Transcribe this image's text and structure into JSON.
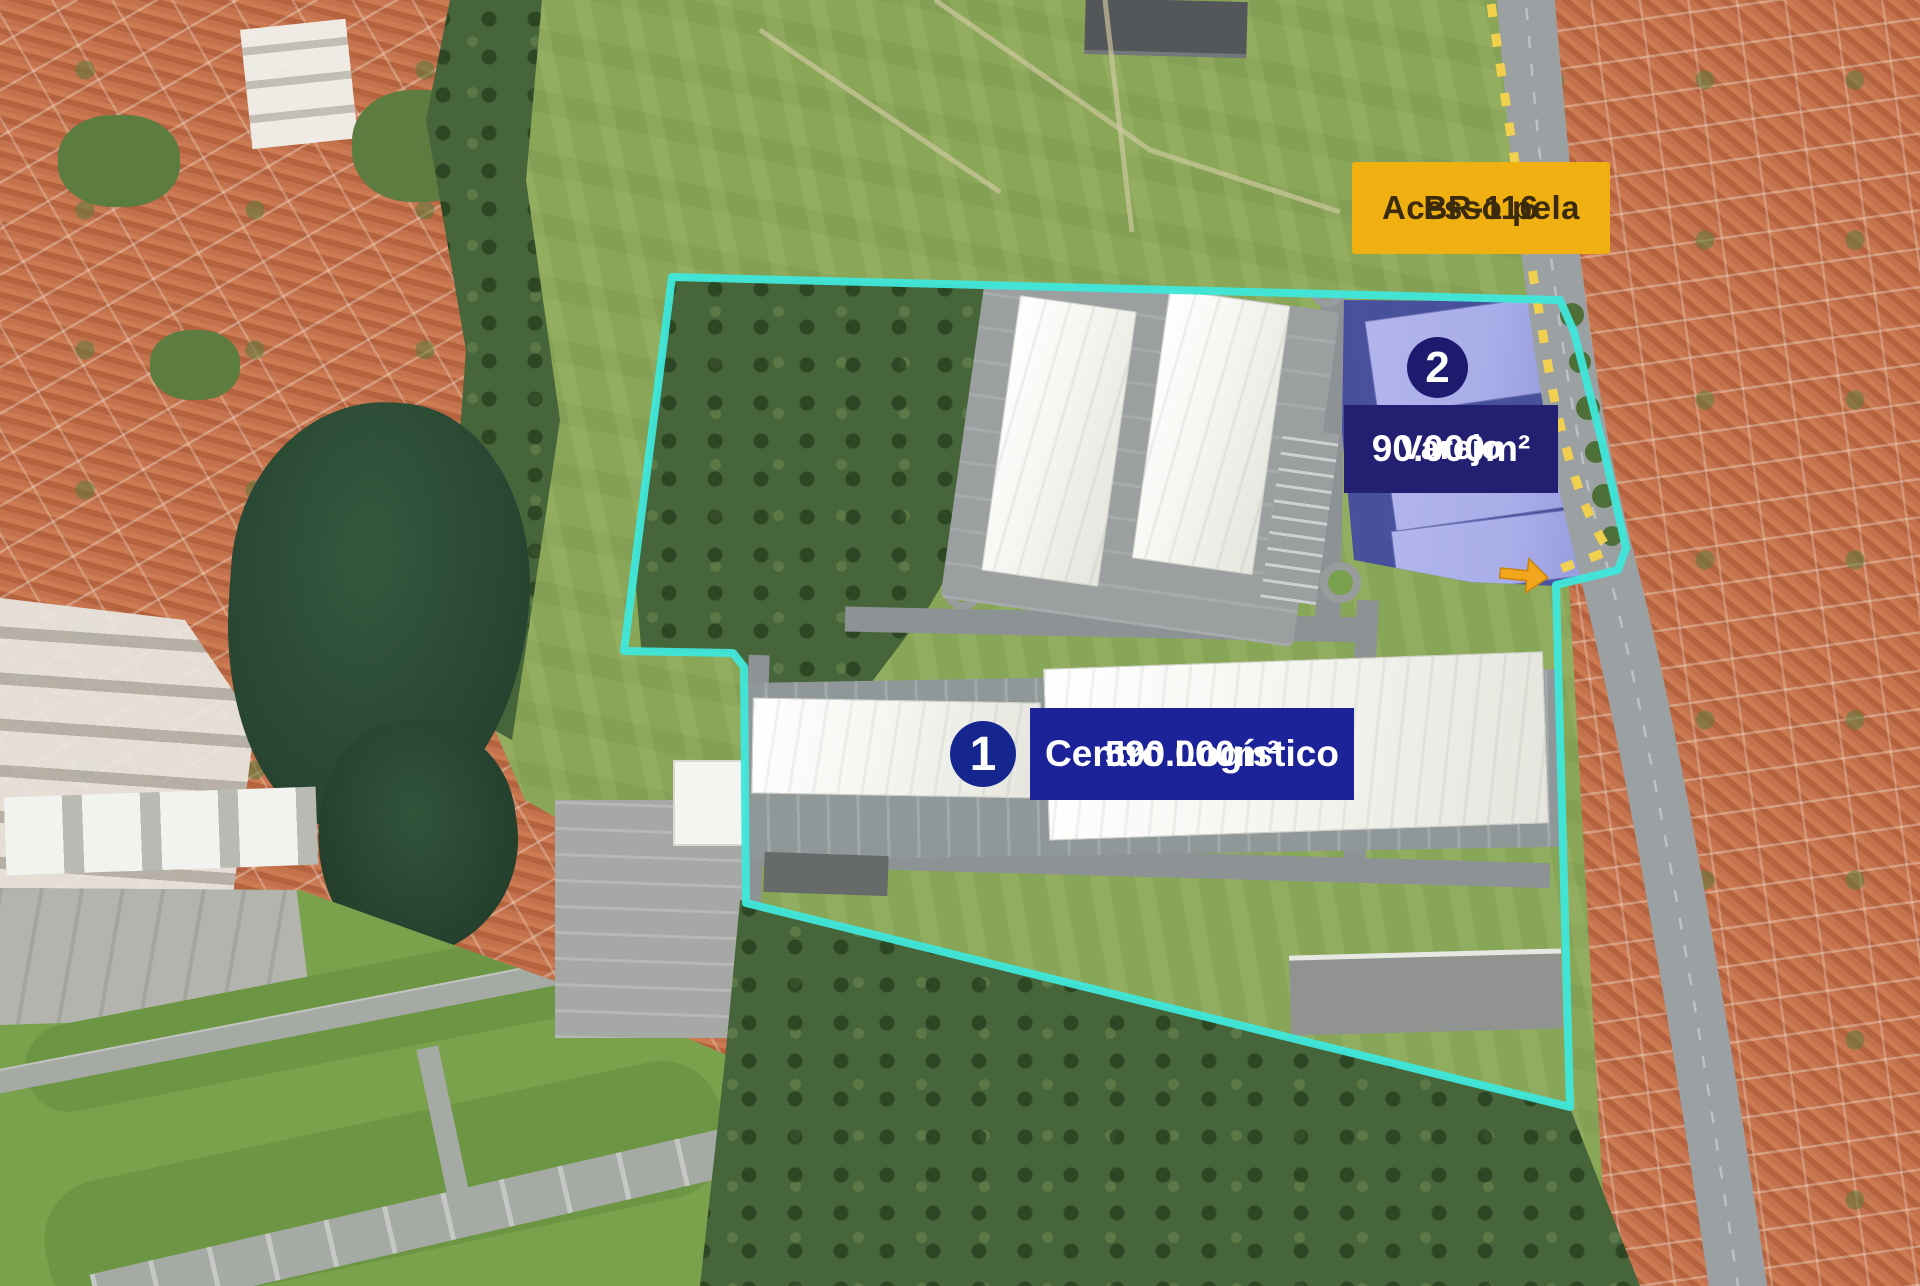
{
  "annotations": {
    "access": {
      "line1": "Acesso pela",
      "line2": "BR-116"
    },
    "zone2": {
      "marker": "2",
      "title": "Varejo",
      "area": "90.000m²"
    },
    "zone1": {
      "marker": "1",
      "title": "Centro Logístico",
      "area": "590.000m²"
    }
  },
  "colors": {
    "boundary_cyan": "#3FE6DA",
    "access_bg": "#F0B012",
    "access_text": "#3B2B0C",
    "marker1_bg": "#15278F",
    "marker2_bg": "#1D1B6E",
    "label1_bg": "#1C2298",
    "label2_bg": "#232072",
    "zone_overlay": "rgba(57,61,169,0.82)",
    "zone_building": "#A9ADE8",
    "route_dash": "#F7D34B",
    "route_arrow": "#F2A61B"
  },
  "icons": {
    "route_arrow": "right-arrow",
    "marker1": "numbered-circle-1",
    "marker2": "numbered-circle-2"
  }
}
